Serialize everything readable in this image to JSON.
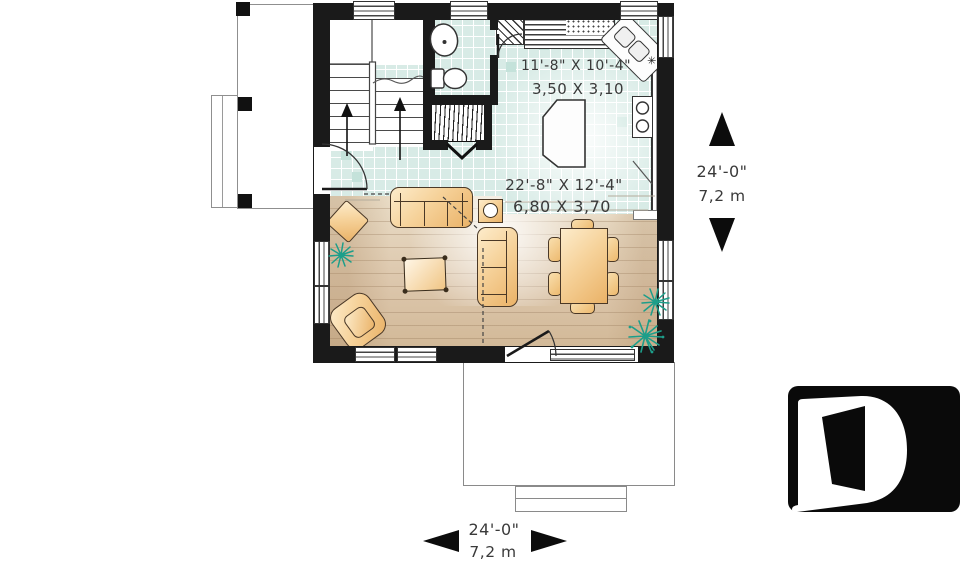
{
  "plan": {
    "kitchen": {
      "dim_imperial": "11'-8\" X 10'-4\"",
      "dim_metric": "3,50 X 3,10"
    },
    "living": {
      "dim_imperial": "22'-8\" X 12'-4\"",
      "dim_metric": "6,80 X 3,70"
    },
    "side_dimension": {
      "imperial": "24'-0\"",
      "metric": "7,2 m"
    },
    "bottom_dimension": {
      "imperial": "24'-0\"",
      "metric": "7,2 m"
    }
  },
  "icons": {
    "side_arrows": [
      "up-arrow",
      "down-arrow"
    ],
    "bottom_arrows": [
      "left-arrow",
      "right-arrow"
    ],
    "logo": "letter-d-logo"
  },
  "colors": {
    "wall": "#1a1a1a",
    "tile": "#d8ebe6",
    "wood": "#dcc6ab",
    "furniture": "#f3c98b",
    "plant": "#1d9e8a",
    "text": "#3a3a3a",
    "logo_background": "#0a0a0a"
  }
}
